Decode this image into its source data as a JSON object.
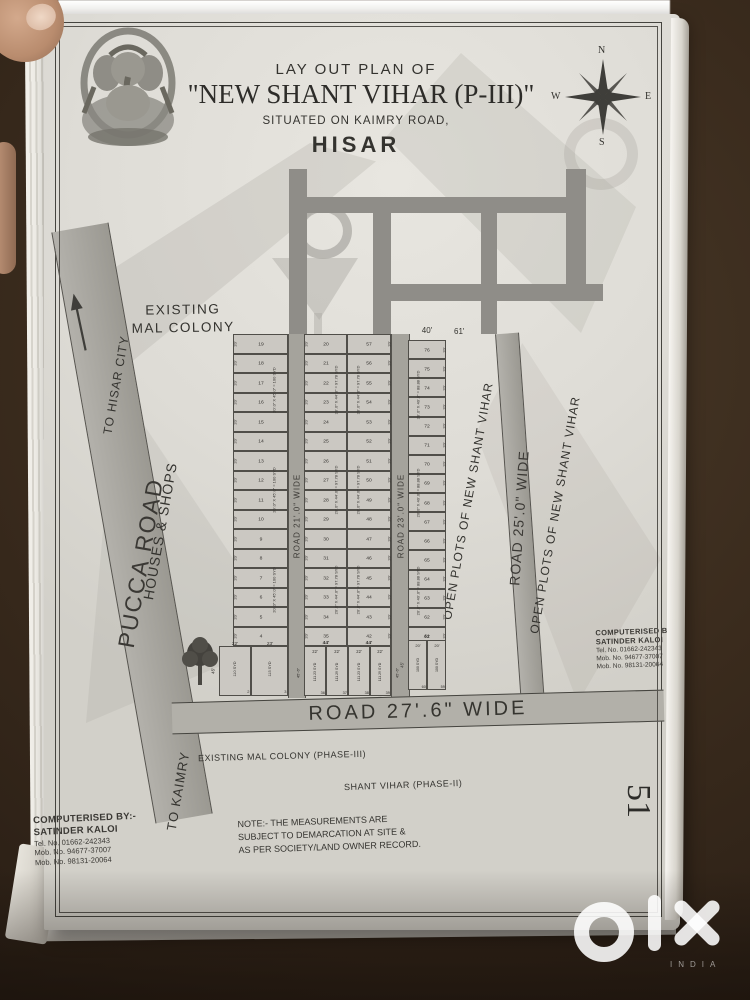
{
  "watermark": {
    "brand": "OLX",
    "country": "INDIA"
  },
  "page": {
    "number": "51"
  },
  "header": {
    "subtitle": "LAY OUT PLAN OF",
    "title": "\"NEW SHANT VIHAR (P-III)\"",
    "location": "SITUATED  ON KAIMRY ROAD,",
    "city": "HISAR",
    "compass": {
      "n": "N",
      "e": "E",
      "s": "S",
      "w": "W"
    }
  },
  "labels": {
    "pucca_road": "PUCCA ROAD",
    "to_hisar_city": "TO HISAR CITY",
    "existing_colony_l1": "EXISTING",
    "existing_colony_l2": "MAL COLONY",
    "houses_shops": "HOUSES & SHOPS",
    "to_kaimry": "TO KAIMRY",
    "open_plots_1": "OPEN PLOTS OF NEW SHANT VIHAR",
    "open_plots_2": "OPEN PLOTS OF NEW SHANT VIHAR",
    "existing_colony_phase3": "EXISTING  MAL  COLONY (PHASE-III)",
    "shant_vihar_phase2": "SHANT VIHAR (PHASE-II)",
    "gap_width": "61'",
    "east_header_width": "40'"
  },
  "roads": {
    "road21": "ROAD 21'.0\" WIDE",
    "road23": "ROAD 23'.0\" WIDE",
    "road25": "ROAD 25'.0\"  WIDE",
    "road27": "ROAD  27'.6\"  WIDE"
  },
  "note": {
    "l1": "NOTE:- THE MEASUREMENTS ARE",
    "l2": "SUBJECT TO DEMARCATION AT SITE &",
    "l3": "AS PER SOCIETY/LAND OWNER RECORD."
  },
  "computerised_left": {
    "l1": "COMPUTERISED BY:-",
    "l2": "SATINDER KALOI",
    "l3": "Tel. No. 01662-242343",
    "l4": "Mob. No. 94677-37007",
    "l5": "Mob. No. 98131-20064"
  },
  "computerised_right": {
    "l1": "COMPUTERISED BY-",
    "l2": "SATINDER KALOI",
    "l3": "Tel. No. 01662-242343",
    "l4": "Mob. No. 94677-37007",
    "l5": "Mob. No. 98131-20064"
  },
  "grid": {
    "columns": [
      {
        "name": "west-row",
        "tick": "20'",
        "tick_side": "left",
        "dim": "20'.0\" X 45'.0\" = 100 SYD",
        "dim_side": "right",
        "plots": [
          19,
          18,
          17,
          16,
          15,
          14,
          13,
          12,
          11,
          10,
          9,
          8,
          7,
          6,
          5,
          4
        ]
      },
      {
        "name": "mid-west-row",
        "tick": "20'",
        "tick_side": "left",
        "dim": "20'.0\" X 44'.0\" = 97.78 SYD",
        "dim_side": "right",
        "plots": [
          20,
          21,
          22,
          23,
          24,
          25,
          26,
          27,
          28,
          29,
          30,
          31,
          32,
          33,
          34,
          35
        ]
      },
      {
        "name": "mid-east-row",
        "tick": "20'",
        "tick_side": "right",
        "dim": "20'.0\" X 44'.0\" = 97.78 SYD",
        "dim_side": "left",
        "plots": [
          57,
          56,
          55,
          54,
          53,
          52,
          51,
          50,
          49,
          48,
          47,
          46,
          45,
          44,
          43,
          42
        ]
      },
      {
        "name": "east-row",
        "tick": "20'",
        "tick_side": "right",
        "dim": "20'.0\" X 40'.0\" = 88.88 SYD",
        "dim_side": "left",
        "plots": [
          76,
          75,
          74,
          73,
          72,
          71,
          70,
          69,
          68,
          67,
          66,
          65,
          64,
          63,
          62,
          61
        ]
      }
    ],
    "special_rows": {
      "west": {
        "widths": [
          "22'",
          "23'"
        ],
        "depth": "45'",
        "areas": [
          "110 SYD",
          "115 SYD"
        ],
        "plots": [
          2,
          3
        ]
      },
      "mid": {
        "spans": [
          "44'",
          "44'"
        ],
        "widths": [
          "22'",
          "22'",
          "22'",
          "22'"
        ],
        "depth": "45'-6\"",
        "areas": [
          "111.23 SYD",
          "111.29 SYD",
          "111.23 SYD",
          "111.29 SYD"
        ],
        "plots": [
          36,
          37,
          38,
          39
        ]
      },
      "east": {
        "span": "40'",
        "widths": [
          "20'",
          "20'"
        ],
        "depth": "45'",
        "areas": [
          "100 SYD",
          "100 SYD"
        ],
        "plots": [
          60,
          59
        ]
      }
    }
  }
}
